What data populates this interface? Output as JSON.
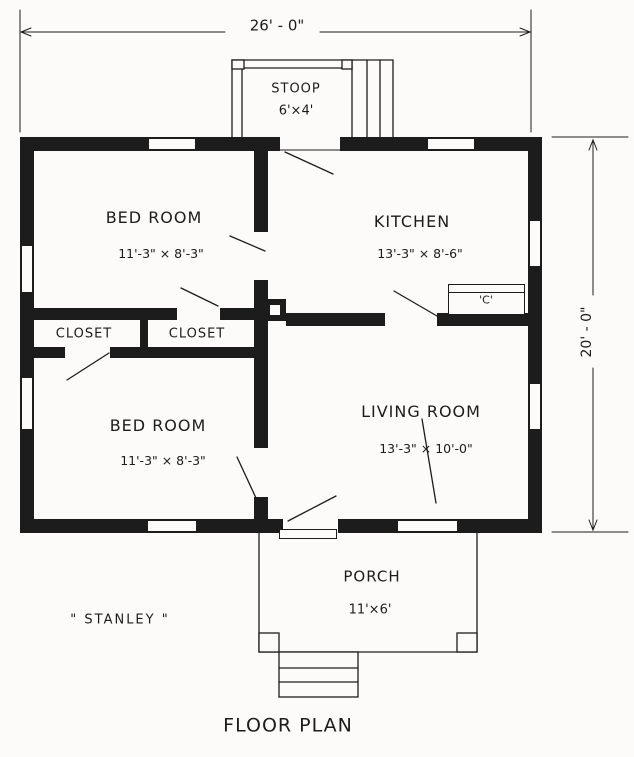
{
  "title": "FLOOR PLAN",
  "plan_name": "\" STANLEY \"",
  "dimensions": {
    "width": "26' - 0\"",
    "depth": "20' - 0\""
  },
  "rooms": {
    "stoop": {
      "name": "STOOP",
      "size": "6'×4'"
    },
    "bedroom_top": {
      "name": "BED ROOM",
      "size": "11'-3\" × 8'-3\""
    },
    "kitchen": {
      "name": "KITCHEN",
      "size": "13'-3\" × 8'-6\""
    },
    "closet_left": {
      "name": "CLOSET"
    },
    "closet_right": {
      "name": "CLOSET"
    },
    "bedroom_bottom": {
      "name": "BED ROOM",
      "size": "11'-3\" × 8'-3\""
    },
    "living_room": {
      "name": "LIVING ROOM",
      "size": "13'-3\" × 10'-0\""
    },
    "porch": {
      "name": "PORCH",
      "size": "11'×6'"
    },
    "cabinet": {
      "label": "'C'"
    }
  },
  "colors": {
    "ink": "#1c1c1c",
    "paper": "#fcfbf9"
  }
}
